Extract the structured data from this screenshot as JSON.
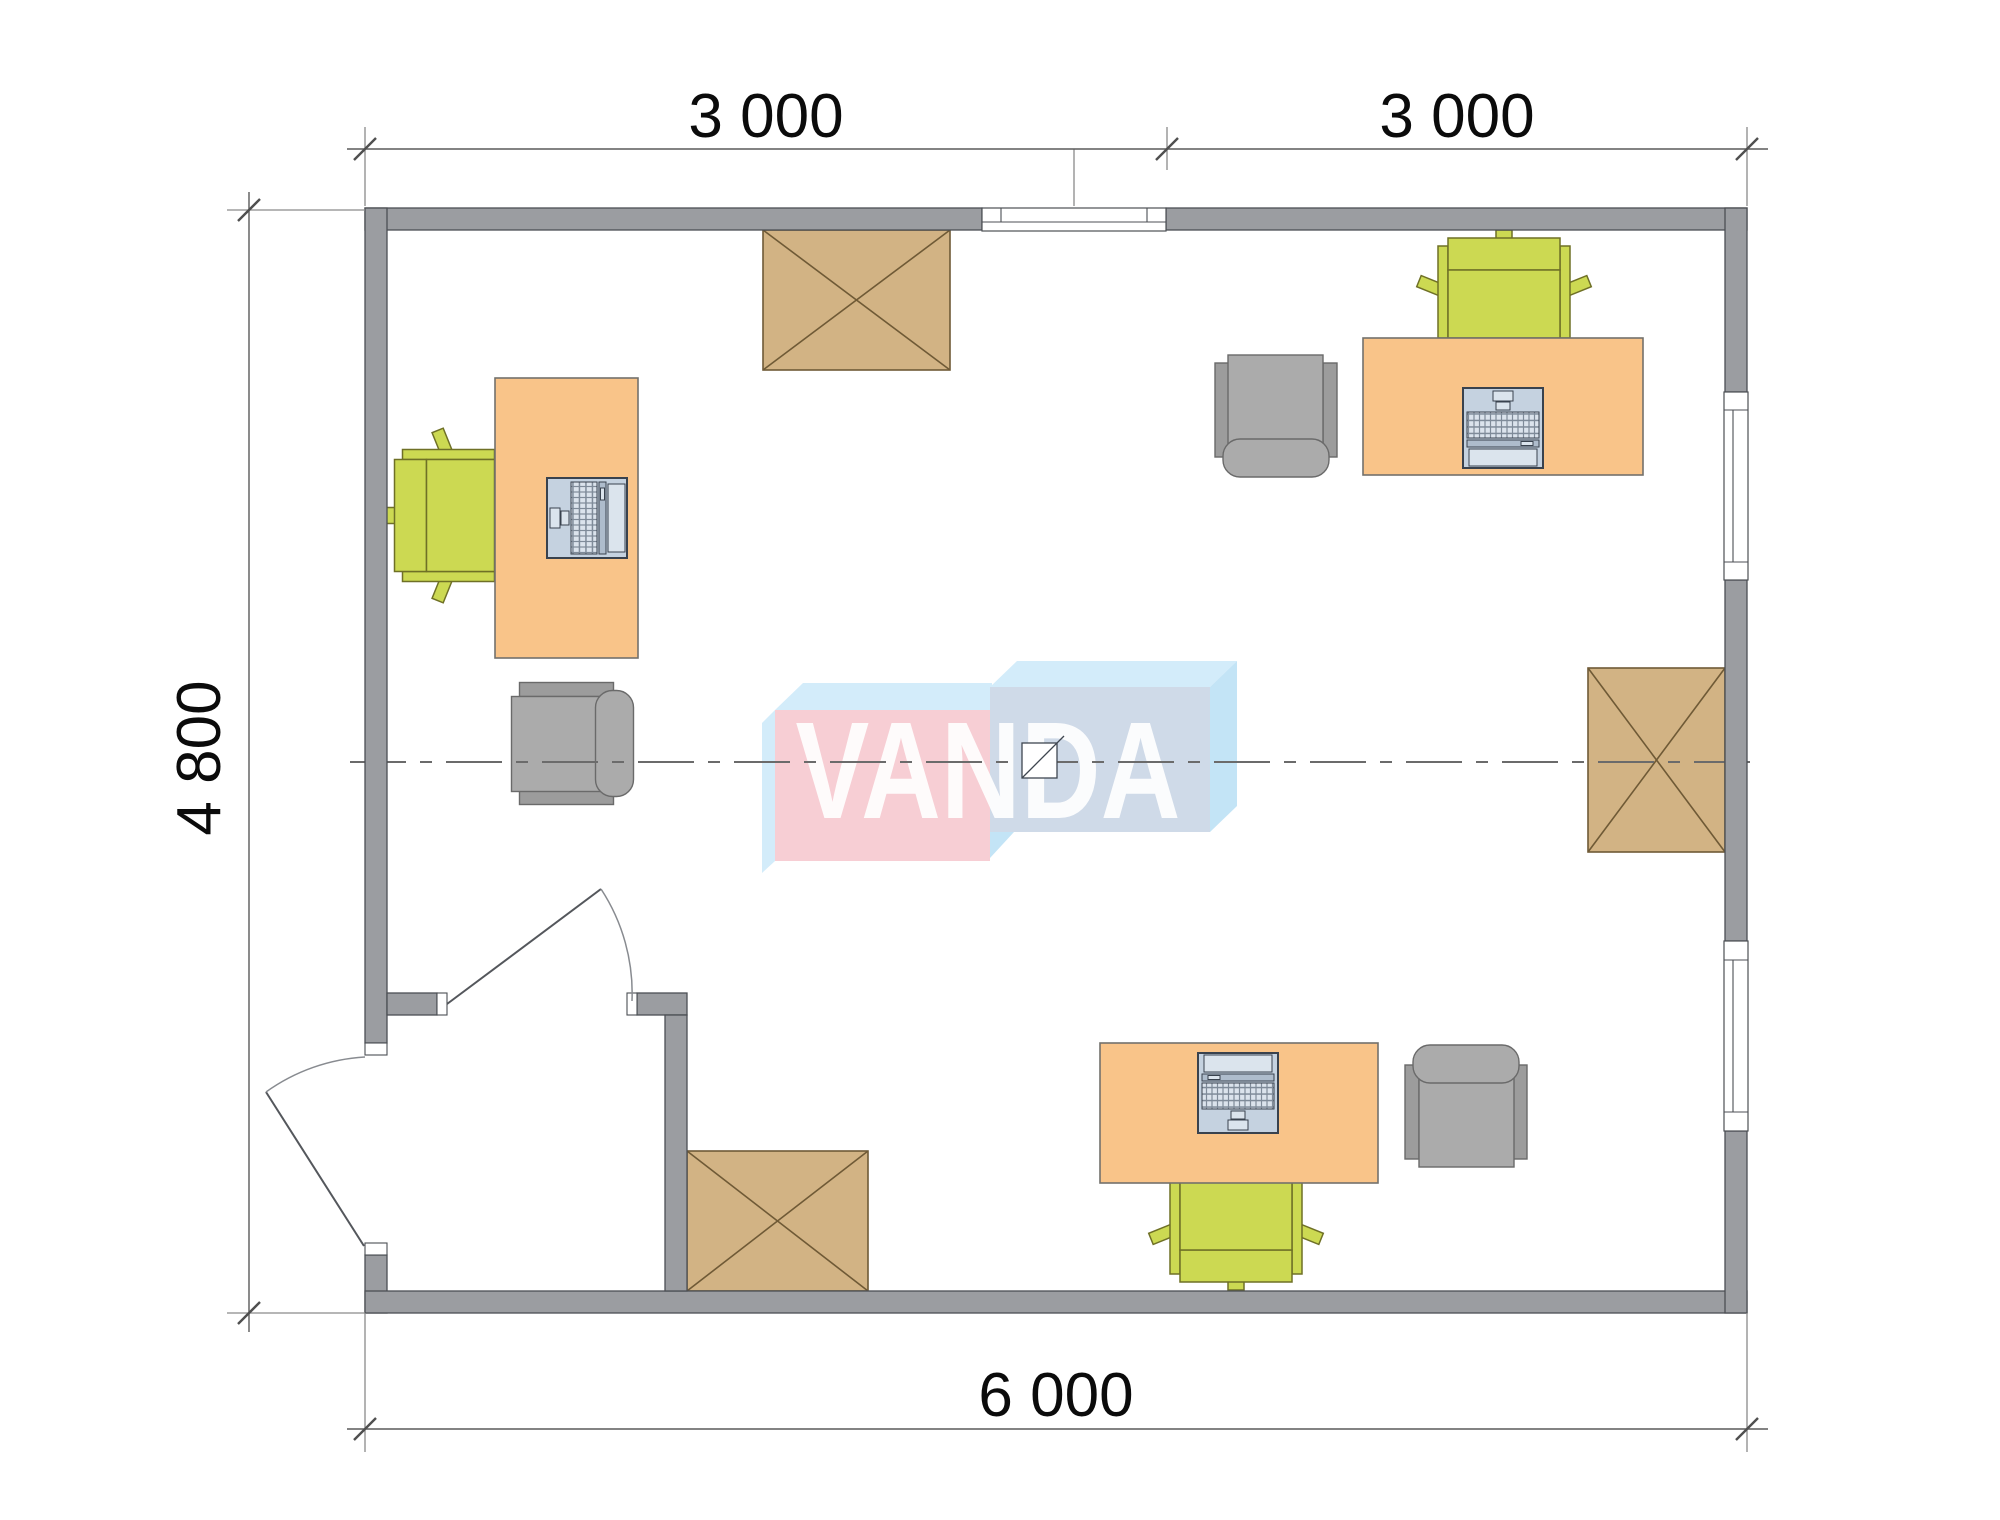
{
  "floor_plan": {
    "dimensions": {
      "top_left": "3 000",
      "top_right": "3 000",
      "left": "4 800",
      "bottom": "6 000"
    },
    "watermark": "VANDA",
    "colors": {
      "wall": "#9b9da1",
      "wall-outline": "#4c4f54",
      "desk": "#f9c489",
      "desk-outline": "#73716c",
      "chair-green": "#ccd952",
      "chair-green-outline": "#6f7026",
      "furn-gray": "#ababab",
      "furn-gray-dark": "#9c9c9c",
      "furn-gray-outline": "#6a6a6a",
      "cabinet": "#d2b384",
      "cabinet-outline": "#6f5a36",
      "laptop": "#c5d2e0",
      "laptop-dark": "#aebccc",
      "laptop-outline": "#39424e",
      "logo-pink": "#f7ced4",
      "logo-blue-front": "#cfdae8",
      "logo-blue-flap": "#d3ecfa",
      "logo-blue-side": "#c3e4f6",
      "dim-line": "#5a5a5a",
      "dim-text": "#0b0b0b"
    }
  }
}
